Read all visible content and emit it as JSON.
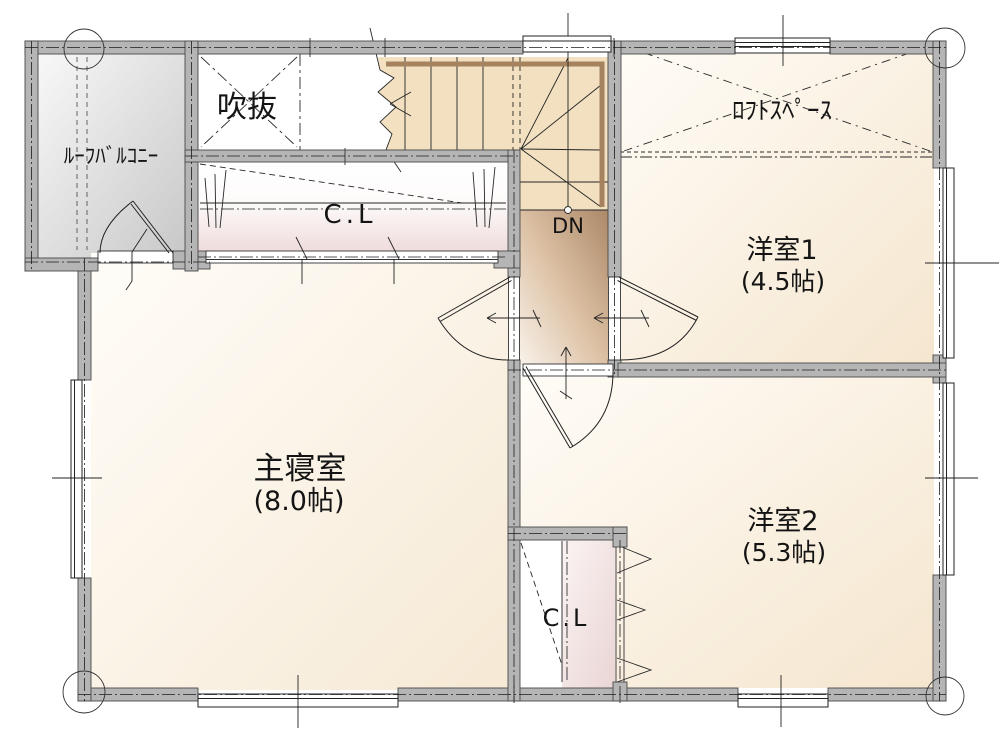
{
  "floorplan": {
    "floor_note": "2F plan",
    "labels": {
      "roof_balcony": "ﾙｰﾌﾊﾞﾙｺﾆｰ",
      "void": "吹抜",
      "loft": "ﾛﾌﾄｽﾍﾟｰｽ",
      "room1_name": "洋室1",
      "room1_size": "(4.5帖)",
      "master_name": "主寝室",
      "master_size": "(8.0帖)",
      "room2_name": "洋室2",
      "room2_size": "(5.3帖)",
      "closet_top": "C.L",
      "closet_bottom": "C.L",
      "stairs_down": "DN"
    },
    "colors": {
      "wall_fill": "#b5b5b5",
      "wall_stroke": "#4a4a4a",
      "stair_fill": "#f2e0c1",
      "handrail_brown": "#a6825e",
      "room_cream": "#f6e8d2",
      "closet_pink": "#eedcdb",
      "hall_brown": "#ab8868",
      "balcony_gray": "#c7c7c7",
      "line_black": "#1f1f1f"
    }
  }
}
